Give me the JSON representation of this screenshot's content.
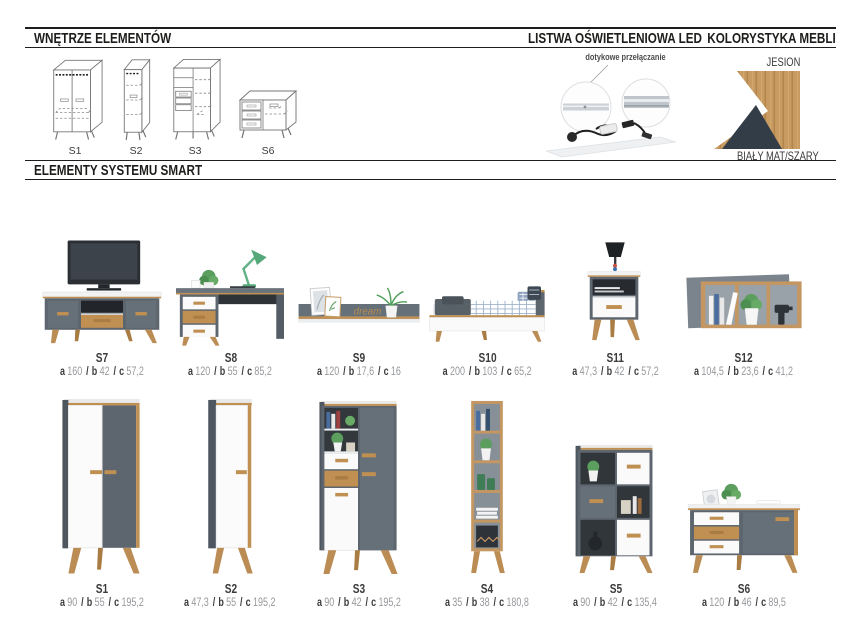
{
  "sections": {
    "interiors": {
      "title": "WNĘTRZE ELEMENTÓW",
      "items": [
        {
          "label": "S1"
        },
        {
          "label": "S2"
        },
        {
          "label": "S3"
        },
        {
          "label": "S6"
        }
      ]
    },
    "led": {
      "title": "LISTWA OŚWIETLENIOWA LED",
      "caption": "dotykowe przełączanie"
    },
    "colors": {
      "title": "KOLORYSTYKA MEBLI",
      "top_label": "JESION",
      "bottom_label": "BIAŁY MAT/SZARY",
      "wood_hex": "#c49762",
      "white_hex": "#ffffff",
      "dark_hex": "#333d48"
    },
    "elements": {
      "title": "ELEMENTY SYSTEMU SMART"
    }
  },
  "palette": {
    "gray": "#5d656e",
    "gray_light": "#667079",
    "wood": "#c08f52",
    "text_dark": "#3b3b3b",
    "num_gray": "#96989b"
  },
  "dim_keys": [
    "a",
    "b",
    "c"
  ],
  "dim_sep": "/",
  "products": [
    {
      "code": "S7",
      "dims": [
        "160",
        "42",
        "57,2"
      ]
    },
    {
      "code": "S8",
      "dims": [
        "120",
        "55",
        "85,2"
      ]
    },
    {
      "code": "S9",
      "dims": [
        "120",
        "17,6",
        "16"
      ],
      "decor_text": "dream"
    },
    {
      "code": "S10",
      "dims": [
        "200",
        "103",
        "65,2"
      ]
    },
    {
      "code": "S11",
      "dims": [
        "47,3",
        "42",
        "57,2"
      ]
    },
    {
      "code": "S12",
      "dims": [
        "104,5",
        "23,6",
        "41,2"
      ]
    },
    {
      "code": "S1",
      "dims": [
        "90",
        "55",
        "195,2"
      ]
    },
    {
      "code": "S2",
      "dims": [
        "47,3",
        "55",
        "195,2"
      ]
    },
    {
      "code": "S3",
      "dims": [
        "90",
        "42",
        "195,2"
      ]
    },
    {
      "code": "S4",
      "dims": [
        "35",
        "38",
        "180,8"
      ]
    },
    {
      "code": "S5",
      "dims": [
        "90",
        "42",
        "135,4"
      ]
    },
    {
      "code": "S6",
      "dims": [
        "120",
        "46",
        "89,5"
      ]
    }
  ]
}
